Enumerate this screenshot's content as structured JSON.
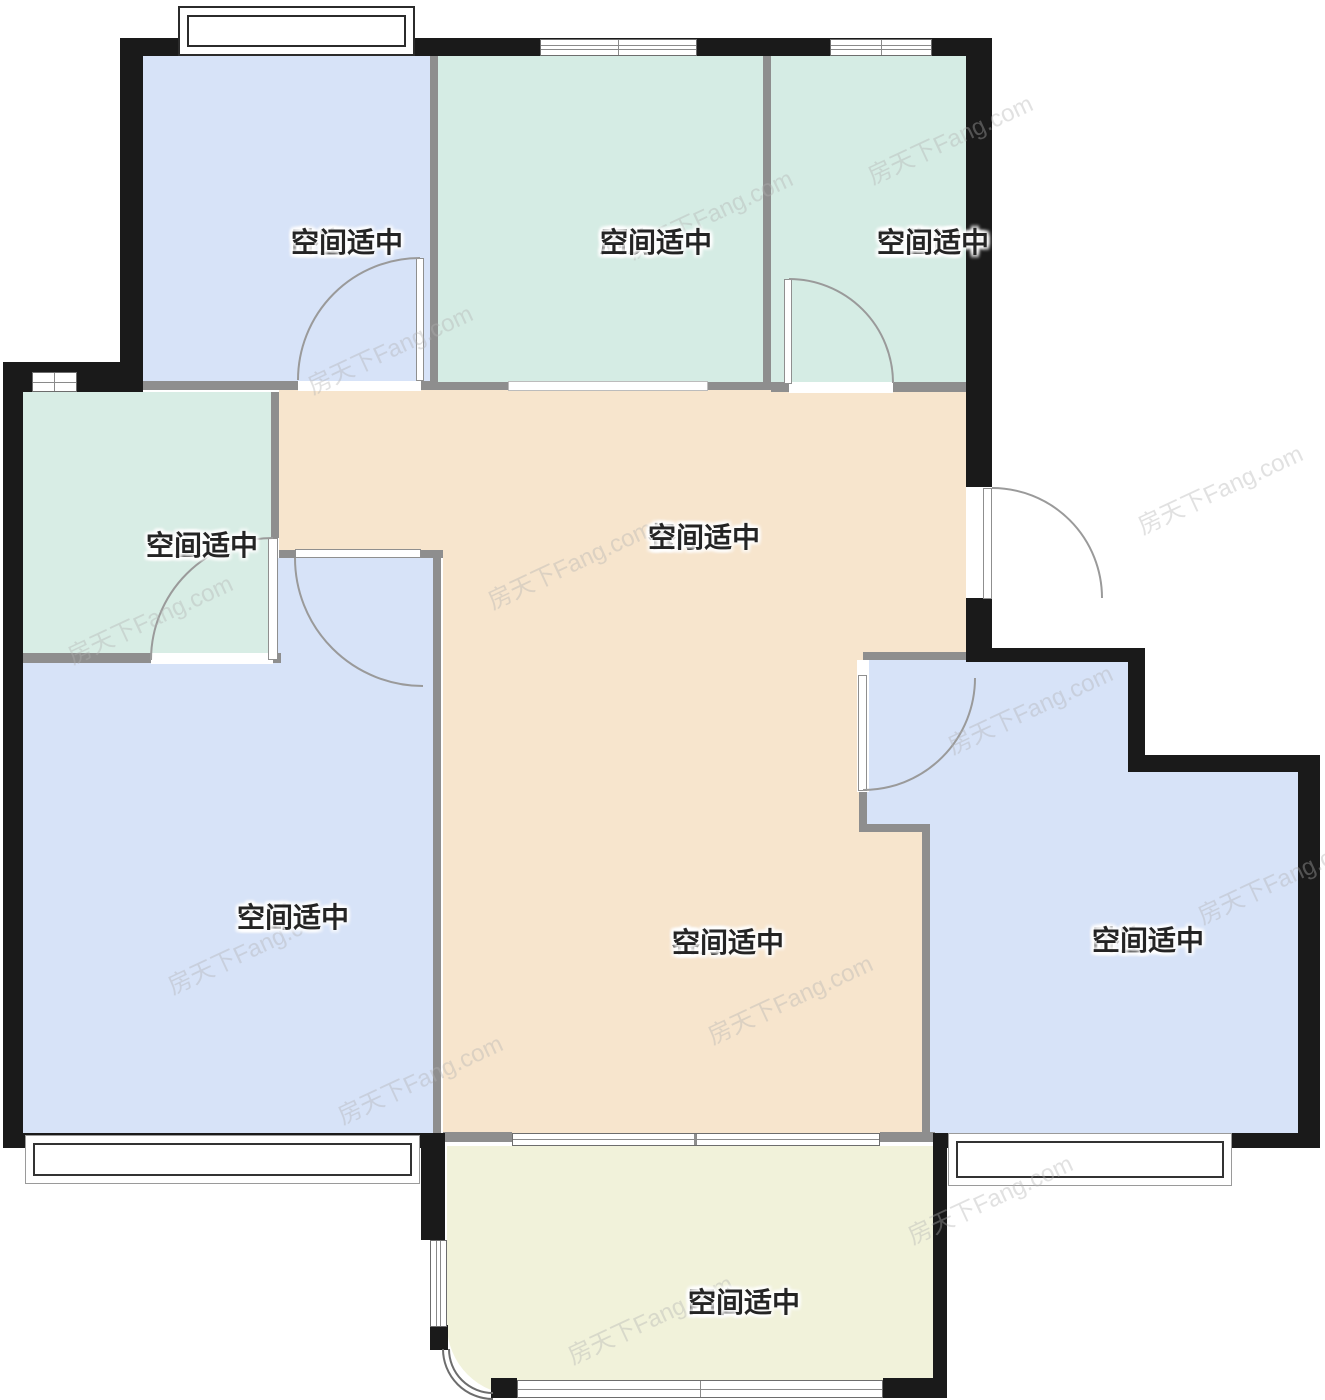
{
  "meta": {
    "title": "apartment-floor-plan",
    "canvas": {
      "width": 1325,
      "height": 1400
    }
  },
  "watermark": {
    "text": "房天下Fang.com"
  },
  "palette": {
    "bedroom_fill": "#d7e3f8",
    "wet_room_fill": "#d5ece4",
    "hall_fill": "#f7e5cd",
    "balcony_fill": "#f1f2da",
    "exterior_wall": "#1a1a1a",
    "interior_wall": "#8e8e8e",
    "door_arc": "#9a9a9a"
  },
  "rooms": [
    {
      "id": "bedroom-a",
      "name": "卧室A",
      "note": "空间适中"
    },
    {
      "id": "kitchen",
      "name": "厨房",
      "note": "空间适中"
    },
    {
      "id": "bathroom",
      "name": "卫生间",
      "note": "空间适中"
    },
    {
      "id": "master-bath",
      "name": "主卫",
      "note": "空间适中"
    },
    {
      "id": "dining-room",
      "name": "餐厅",
      "note": "空间适中"
    },
    {
      "id": "master-bedroom",
      "name": "主卧",
      "note": "空间适中"
    },
    {
      "id": "living-room",
      "name": "客厅",
      "note": "空间适中"
    },
    {
      "id": "bedroom-b",
      "name": "卧室B",
      "note": "空间适中"
    },
    {
      "id": "balcony",
      "name": "阳台",
      "note": "空间适中"
    }
  ]
}
